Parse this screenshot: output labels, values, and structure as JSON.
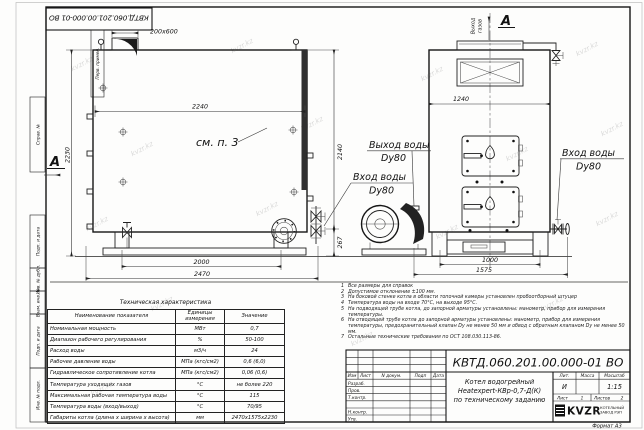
{
  "watermark": "kvzr.kz",
  "stamp": {
    "doc_number": "КВТД.060.201.00.000-01 ВО"
  },
  "margin": {
    "perv": "Перв. примен.",
    "sprav": "Справ. №",
    "podp1": "Подп. и дата",
    "inv_dubl": "Инв. № дубл.",
    "vzam": "Взам. инв. №",
    "podp2": "Подп. и дата",
    "inv_podl": "Инв. № подл."
  },
  "dims": {
    "stub": "200х600",
    "top_width": "2240",
    "left_height": "2230",
    "right_height": "2140",
    "pipe_height": "267",
    "legs_span": "2000",
    "total_length": "2470",
    "front_width": "1240",
    "front_legs": "1000",
    "front_total": "1575"
  },
  "labels": {
    "see_note": "см. п. 3",
    "view_a_left": "A",
    "view_a_right": "A",
    "gas_out_1": "Выход",
    "gas_out_2": "газов",
    "water_out": "Выход воды",
    "water_out_dn": "Dy80",
    "water_in": "Вход воды",
    "water_in_dn": "Dy80",
    "water_in_r": "Вход воды",
    "water_in_r_dn": "Dy80"
  },
  "tech": {
    "title": "Техническая характеристика",
    "col_name": "Наименование показателя",
    "col_units_1": "Единицы",
    "col_units_2": "измерения",
    "col_value": "Значение",
    "rows": [
      {
        "name": "Номинальная мощность",
        "units": "МВт",
        "value": "0,7"
      },
      {
        "name": "Диапазон рабочего регулирования",
        "units": "%",
        "value": "50-100"
      },
      {
        "name": "Расход воды",
        "units": "м3/ч",
        "value": "24"
      },
      {
        "name": "Рабочее давление воды",
        "units": "МПа (кгс/см2)",
        "value": "0,6 (6,0)"
      },
      {
        "name": "Гидравлическое сопротивление котла",
        "units": "МПа (кгс/см2)",
        "value": "0,06 (0,6)"
      },
      {
        "name": "Температура уходящих газов",
        "units": "°С",
        "value": "не более 220"
      },
      {
        "name": "Максимальная рабочая температура воды",
        "units": "°С",
        "value": "115"
      },
      {
        "name": "Температура воды (вход/выход)",
        "units": "°С",
        "value": "70/95"
      },
      {
        "name": "Габариты котла (длина х ширина х высота)",
        "units": "мм",
        "value": "2470х1575х2230"
      }
    ]
  },
  "notes": [
    {
      "n": "1",
      "t": "Все размеры для справок"
    },
    {
      "n": "2",
      "t": "Допустимое отклонение ±100 мм."
    },
    {
      "n": "3",
      "t": "На боковой стенке котла в области топочной камеры установлен пробоотборный штуцер"
    },
    {
      "n": "4",
      "t": "Температура воды на входе 70°С, на выходе 95°С."
    },
    {
      "n": "5",
      "t": "На подводящей трубе котла, до запорной арматуры установлены: манометр, прибор для измерения температуры."
    },
    {
      "n": "6",
      "t": "На отводящей трубе котла до запорной арматуры установлены: манометр, прибор для измерения температуры, предохранительный клапан Dy не менее 50 мм и обвод с обратным клапаном Dy не менее 50 мм."
    },
    {
      "n": "7",
      "t": "Остальные технические требования по ОСТ 108.030.113-86."
    }
  ],
  "tb": {
    "doc_number": "КВТД.060.201.00.000-01 ВО",
    "izm": "Изм",
    "list": "Лист",
    "ndoc": "N докум.",
    "podp": "Подп",
    "data": "Дата",
    "razrab": "Разраб.",
    "prov": "Пров.",
    "tkontr": "Т.контр.",
    "nkontr": "Н.контр.",
    "utv": "Утв.",
    "name1": "Котел водогрейный",
    "name2": "Heatexpert-КВр-0,7-Д(К)",
    "name3": "по техническому заданию",
    "lit_label": "Лит.",
    "mass_label": "Масса",
    "scale_label": "Масштаб",
    "lit": "И",
    "scale": "1:15",
    "sheet_label": "Лист",
    "sheet": "1",
    "sheets_label": "Листов",
    "sheets": "2",
    "logo": "KVZR",
    "logo_cap1": "КОТЕЛЬНЫЙ",
    "logo_cap2": "ЗАВОД РЭП",
    "format": "Формат А3"
  }
}
